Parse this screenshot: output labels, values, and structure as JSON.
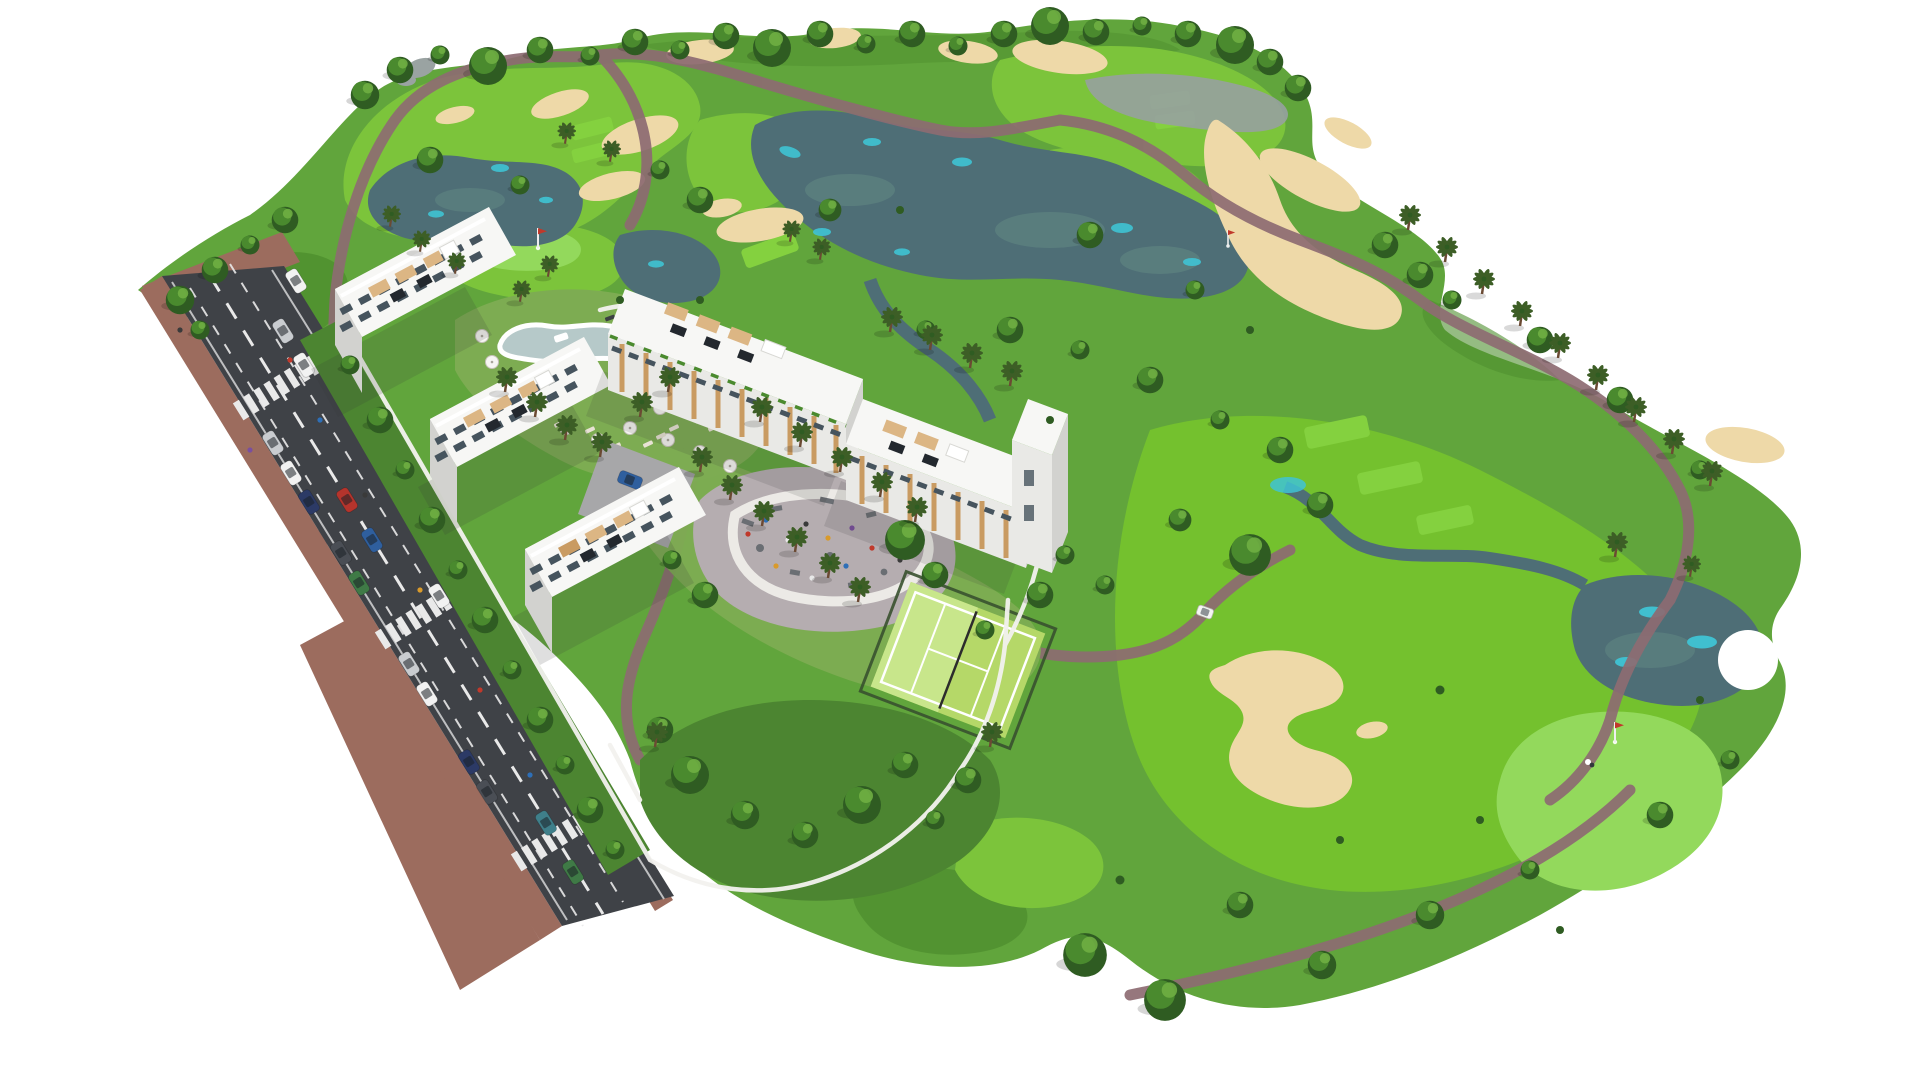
{
  "scene": {
    "type": "architectural-aerial-render",
    "title": "Aerial 3D render of a golf-resort apartment development",
    "description": "Isometric aerial rendering on a white background: five white low-rise apartment blocks with rooftop terraces, timber pergolas and solar panels stand beside a two-lane road with brick-paver sidewalks, zebra crossings and parked cars. Landscaped grounds hold a lagoon swimming pool with parasols and sun loungers, a playground plaza, a fenced padel court and walled gardens. A golf course with fairways, putting greens, flags, sand bunkers, lakes, streams, winding cart paths, round trees and palm trees wraps around the residential plot.",
    "background": "#ffffff"
  },
  "palette": {
    "rough": "#61a53c",
    "rough_dark": "#4f8f2e",
    "garden_dark": "#4c8531",
    "fairway": "#7cc43b",
    "fairway_bright": "#74c12e",
    "green_bright": "#93d95c",
    "tee": "#84d13f",
    "lawn": "#7dac52",
    "sand": "#eed9a8",
    "sand_edge": "#dcc488",
    "water": "#4e6e76",
    "water_mid": "#5d8180",
    "water_cyan": "#3fc3d4",
    "water_gray": "#97a1a0",
    "pool": "#b6c9c9",
    "road": "#3f4247",
    "marking": "#e9e9e9",
    "brick": "#9c6c5e",
    "curb": "#d8d6d0",
    "plaza": "#b5adb0",
    "plaza_path": "#eceae6",
    "wall": "#f3f2ef",
    "bldg_roof": "#f7f7f5",
    "bldg_front": "#e9e9e6",
    "bldg_side": "#d2d2cf",
    "glass": "#46545e",
    "wood": "#c99b62",
    "wood_light": "#dcb684",
    "solar": "#23282e",
    "tree_dark": "#2f5c22",
    "tree_mid": "#4a8a2e",
    "tree_light": "#6fae43",
    "palm": "#3d5e26",
    "trunk": "#6b4a33",
    "padel": "#b5d868",
    "padel_light": "#c8e68b",
    "fence": "#39512f",
    "path": "#8d6b72",
    "rock": "#9aa3a2",
    "flag_red": "#c0392b"
  },
  "inventory": {
    "apartment_blocks": 5,
    "stories_per_block": 4,
    "golf_lakes": 4,
    "sand_bunkers": 12,
    "putting_greens": 3,
    "tee_boxes": 7,
    "golf_flags": 3,
    "golf_carts": 1,
    "crosswalks": 3,
    "cars": 19,
    "padel_courts": 1,
    "swimming_pools": 1,
    "playground_plazas": 1
  },
  "car_colors": [
    "#f2f2f2",
    "#c9ccd0",
    "#b5342c",
    "#2f5f9e",
    "#3f7f8a",
    "#3f7a46",
    "#2c3a66",
    "#4a4e55"
  ],
  "people_colors": [
    "#c0392b",
    "#2e6fb7",
    "#e8e8e8",
    "#3a3a3a",
    "#d99a2b",
    "#7a4f9e"
  ]
}
